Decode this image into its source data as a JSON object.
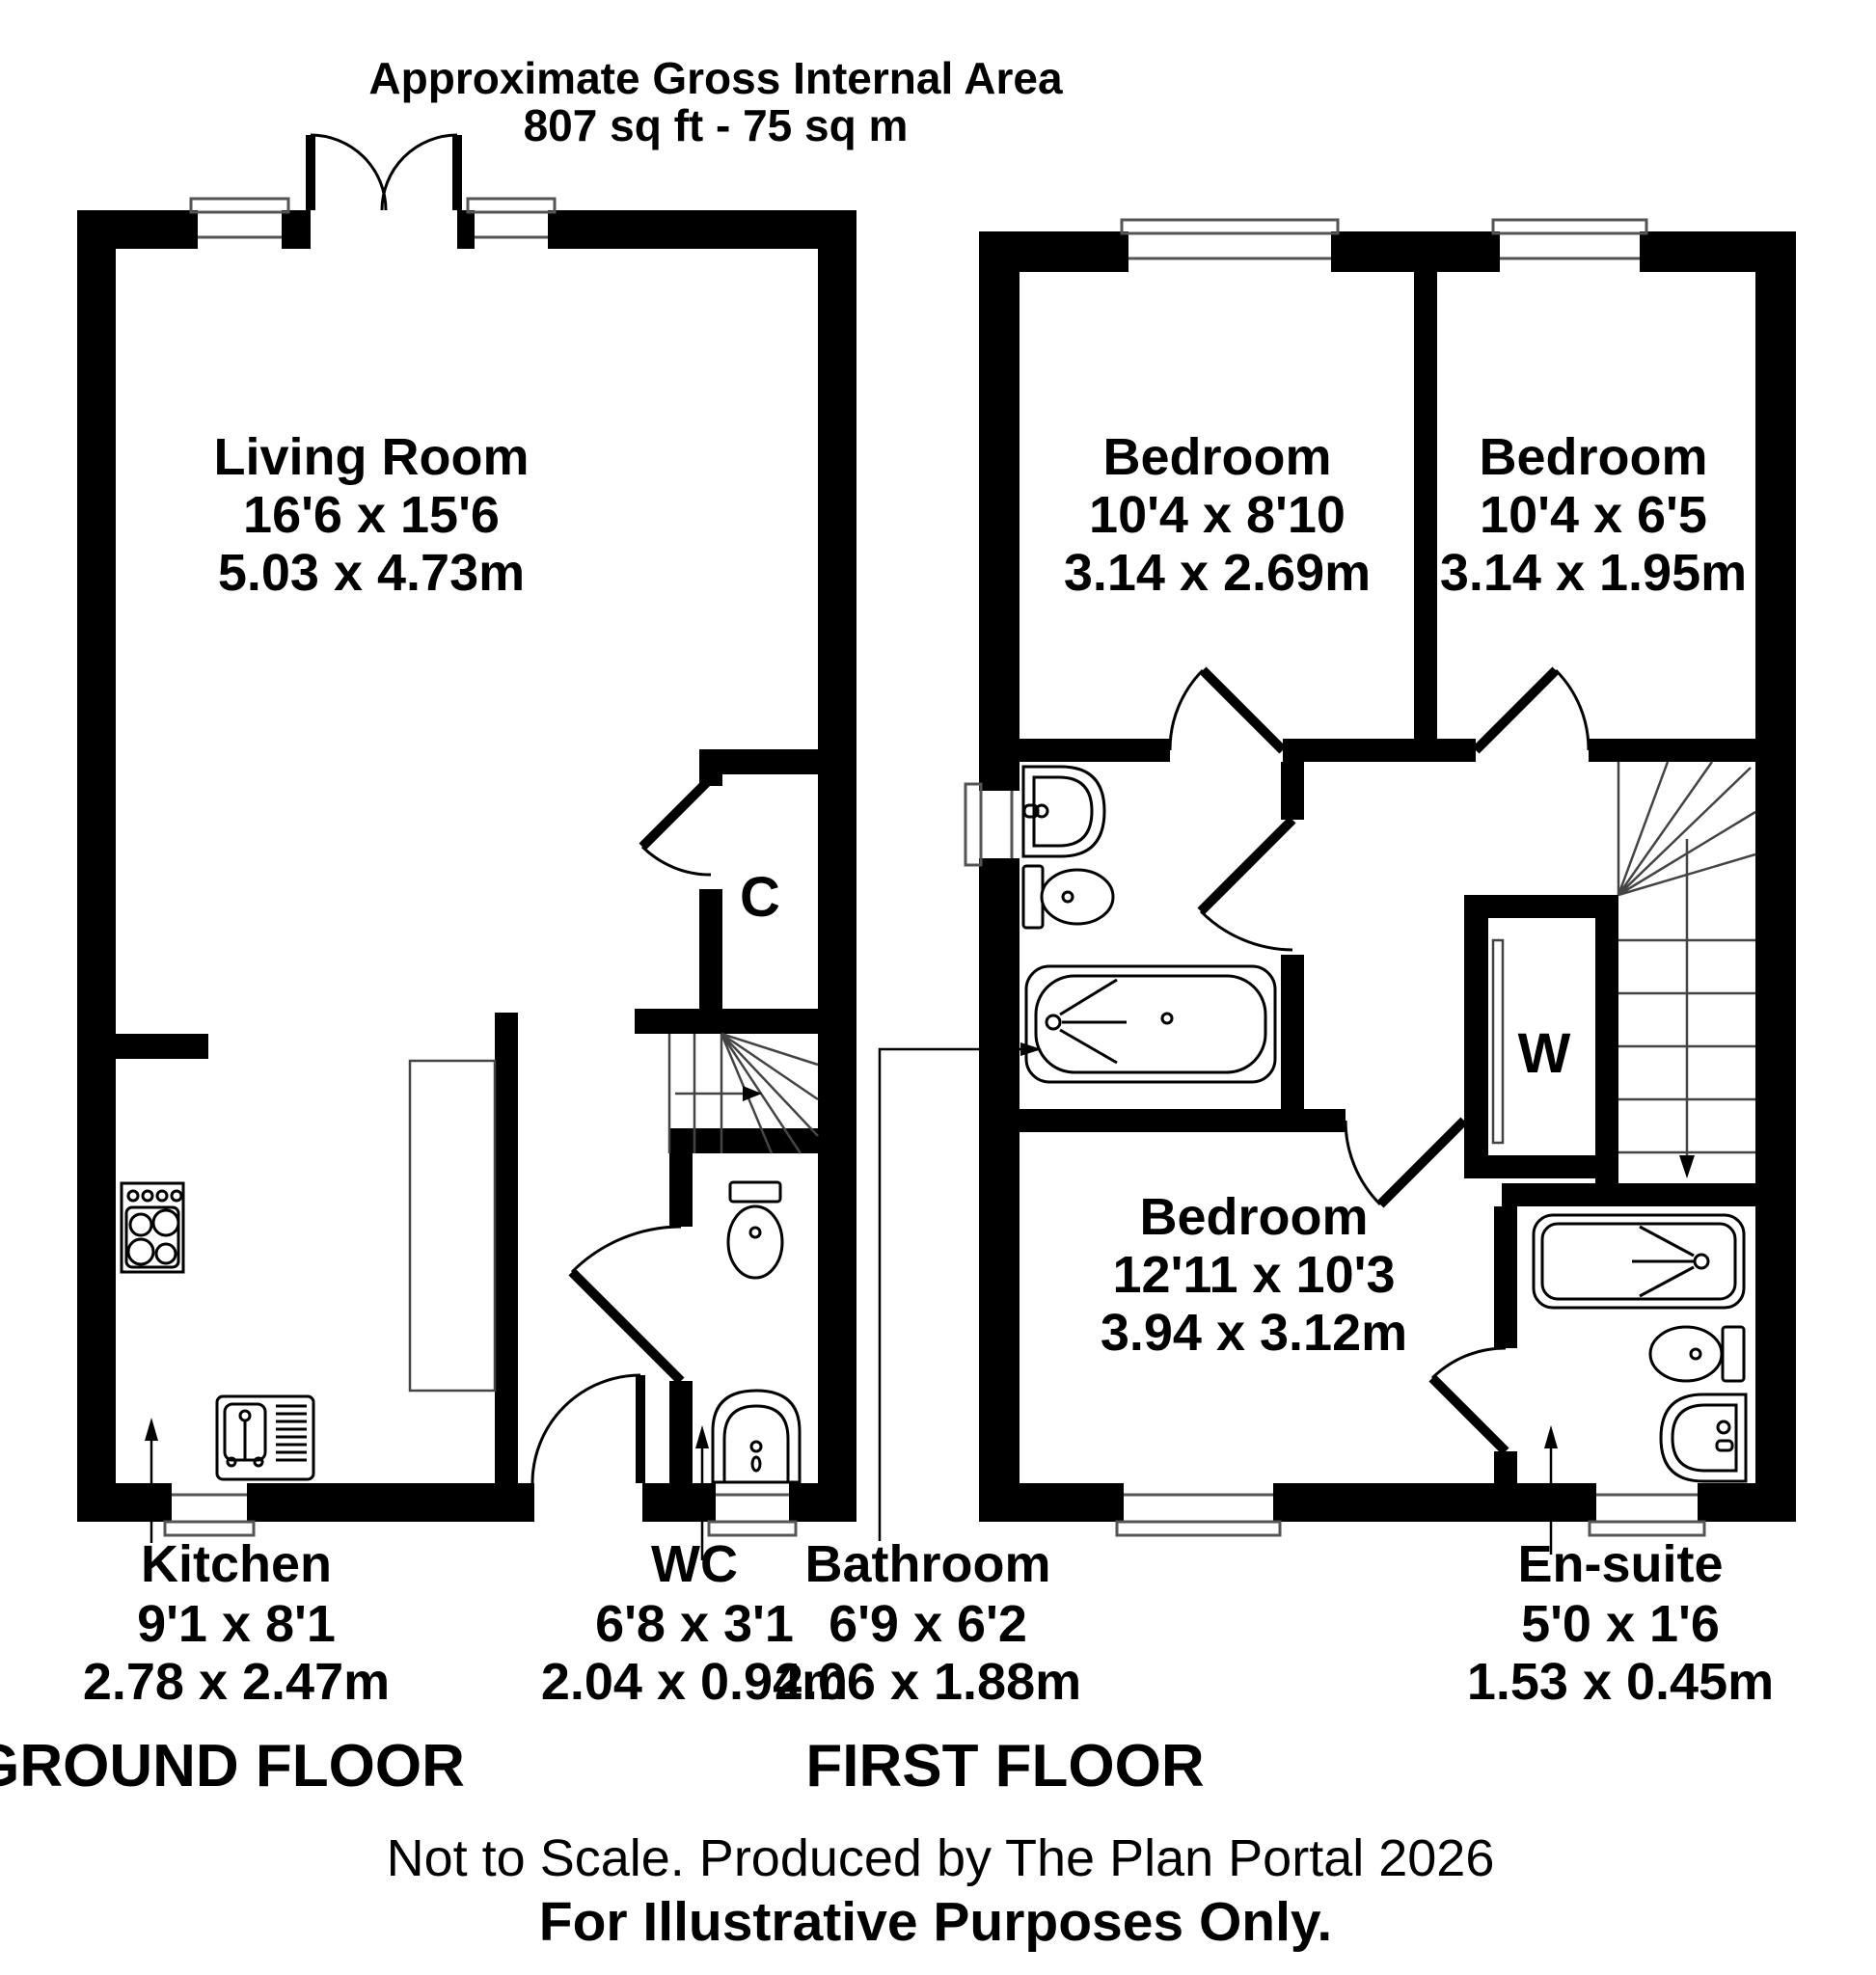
{
  "header": {
    "title": "Approximate Gross Internal Area",
    "subtitle": "807 sq ft - 75 sq m"
  },
  "floors": {
    "ground": {
      "label": "GROUND FLOOR"
    },
    "first": {
      "label": "FIRST FLOOR"
    }
  },
  "rooms": {
    "living_room": {
      "name": "Living Room",
      "imperial": "16'6 x 15'6",
      "metric": "5.03 x 4.73m"
    },
    "kitchen": {
      "name": "Kitchen",
      "imperial": "9'1 x 8'1",
      "metric": "2.78 x 2.47m"
    },
    "wc": {
      "name": "WC",
      "imperial": "6'8 x 3'1",
      "metric": "2.04 x 0.94m"
    },
    "cupboard": {
      "name": "C"
    },
    "bedroom1": {
      "name": "Bedroom",
      "imperial": "10'4 x 8'10",
      "metric": "3.14 x 2.69m"
    },
    "bedroom2": {
      "name": "Bedroom",
      "imperial": "10'4 x 6'5",
      "metric": "3.14 x 1.95m"
    },
    "bedroom3": {
      "name": "Bedroom",
      "imperial": "12'11 x 10'3",
      "metric": "3.94 x 3.12m"
    },
    "bathroom": {
      "name": "Bathroom",
      "imperial": "6'9 x 6'2",
      "metric": "2.06 x 1.88m"
    },
    "ensuite": {
      "name": "En-suite",
      "imperial": "5'0 x 1'6",
      "metric": "1.53 x 0.45m"
    },
    "wardrobe": {
      "name": "W"
    }
  },
  "footer": {
    "line1": "Not to Scale. Produced by The Plan Portal 2026",
    "line2": "For Illustrative Purposes Only."
  },
  "icons": [
    "stove-icon",
    "kitchen-sink-icon",
    "toilet-icon",
    "basin-icon",
    "bath-icon",
    "shower-bath-icon",
    "stairs-up-icon",
    "stairs-down-icon",
    "door-arc-icon",
    "window-icon",
    "wardrobe-door-icon"
  ],
  "colors": {
    "wall": "#000000",
    "background": "#ffffff",
    "text": "#000000"
  }
}
